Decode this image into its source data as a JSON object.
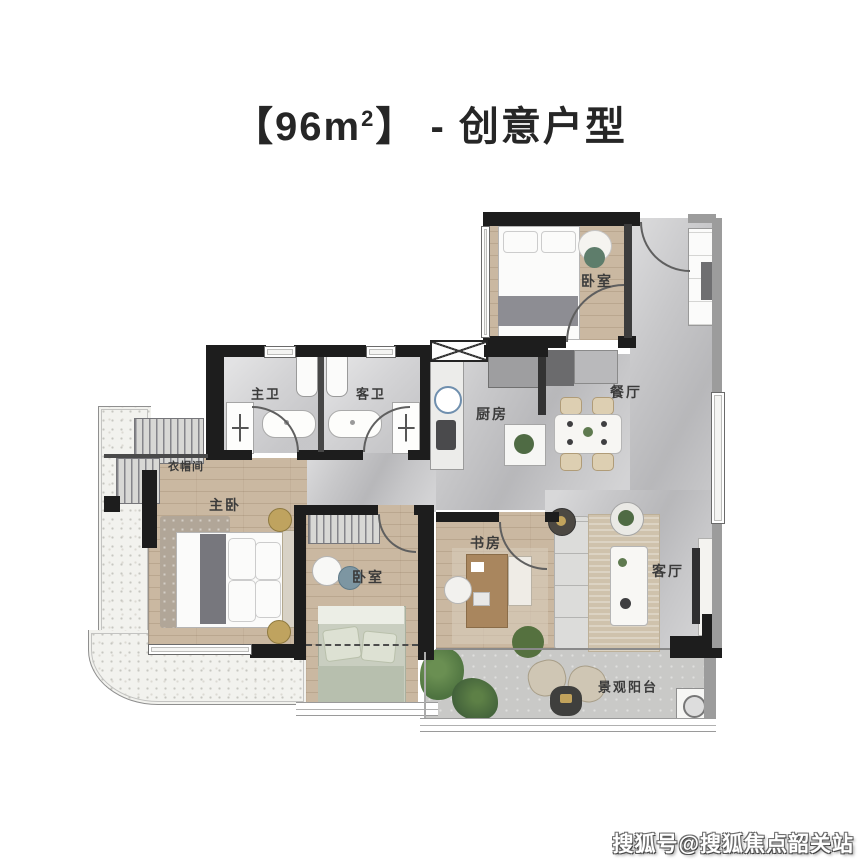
{
  "title": {
    "prefix": "【96m",
    "sup": "2",
    "suffix": "】 - 创意户型"
  },
  "rooms": {
    "bedroom_top": {
      "label": "卧室"
    },
    "dining": {
      "label": "餐厅"
    },
    "kitchen": {
      "label": "厨房"
    },
    "master_bath": {
      "label": "主卫"
    },
    "guest_bath": {
      "label": "客卫"
    },
    "cloakroom": {
      "label": "衣帽间"
    },
    "master_bedroom": {
      "label": "主卧"
    },
    "second_bedroom": {
      "label": "卧室"
    },
    "study": {
      "label": "书房"
    },
    "living_room": {
      "label": "客厅"
    },
    "balcony": {
      "label": "景观阳台"
    }
  },
  "watermark": {
    "text": "搜狐号@搜狐焦点韶关站"
  },
  "colors": {
    "wall": "#1d1d1d",
    "secondary_wall": "#9c9c9c",
    "wood_floor": "#cab8a1",
    "marble_floor": "#c7c7c9",
    "bath_floor": "#d3d3d5",
    "terrace": "#f2f2ee",
    "label_text": "#3b3b3b",
    "title_text": "#262626",
    "plant_green": "#4e7340",
    "watermark_text": "#ffffff"
  }
}
